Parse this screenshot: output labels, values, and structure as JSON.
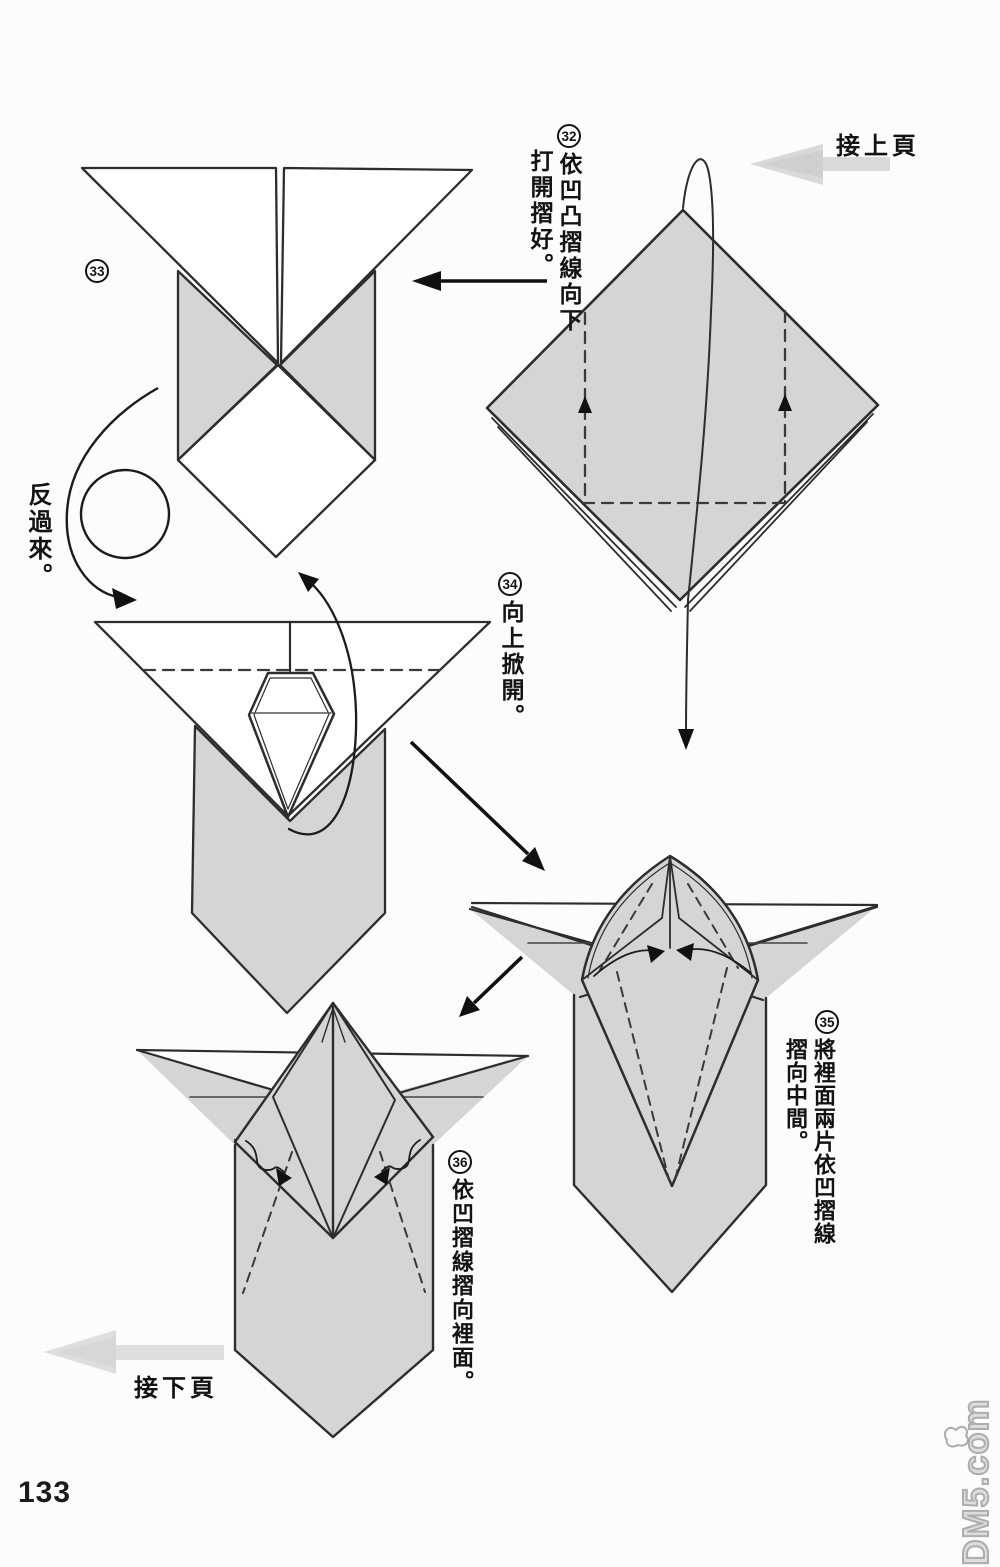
{
  "page": {
    "number": "133",
    "watermark": "DM5.com"
  },
  "nav": {
    "prev_label": "接上頁",
    "next_label": "接下頁",
    "prev_arrow_icon": "thick-gray-arrow-left",
    "next_arrow_icon": "thick-gray-arrow-left"
  },
  "flip_label": "反過來。",
  "steps": {
    "s32": {
      "num": "32",
      "col1": "依凹凸摺線向下",
      "col2": "打開摺好。"
    },
    "s33": {
      "num": "33"
    },
    "s34": {
      "num": "34",
      "col1": "向上掀開。"
    },
    "s35": {
      "num": "35",
      "col1": "將裡面兩片依凹摺線",
      "col2": "摺向中間。"
    },
    "s36": {
      "num": "36",
      "col1": "依凹摺線摺向裡面。"
    }
  },
  "colors": {
    "paper_gray": "#d5d5d5",
    "line": "#2d2d2d",
    "nav_arrow_gray": "#d2d2d2",
    "watermark_gray": "#a0a0a0"
  }
}
